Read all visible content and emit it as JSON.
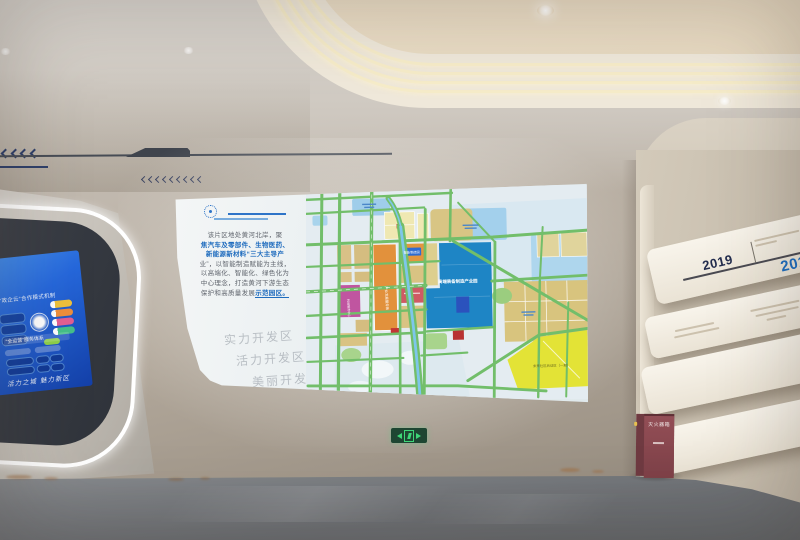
{
  "scene": {
    "description": "展厅实景：弧形灯带吊顶、墙面投影城市规划图、左侧蓝色触控屏、右侧年代墙、安全出口标识与灭火器箱"
  },
  "projection": {
    "intro": {
      "l1": "该片区地处黄河北岸，聚",
      "l2": "焦汽车及零部件、生物医药、",
      "l3": "新能源新材料“三大主导产",
      "l4": "业”，以智能制造赋能为主线，",
      "l5": "以高端化、智能化、绿色化为",
      "l6": "中心理念，打造黄河下游生态",
      "l7a": "保护和高质量发展",
      "l7b": "示范园区。"
    },
    "watermarks": {
      "w1": "实力开发区",
      "w2": "活力开发区",
      "w3": "美丽开发区"
    },
    "map": {
      "zone_blue": "高端装备制造产业园",
      "zone_corridor": "产业发展服务轴",
      "zone_magenta": "科创服务中心",
      "zone_yellow": "未来社区启动区（一期）",
      "tag_orange": "智能制造园"
    }
  },
  "kiosk": {
    "title1": "“政企云”合作模式机制",
    "title2": "“全运营”服务体系",
    "signature": "活力之城 魅力新区"
  },
  "timeline": {
    "year1": "2019",
    "year2": "2019"
  },
  "safety": {
    "fire_box_label": "灭火器箱"
  },
  "palette": {
    "led_warm": "#f6ecc9",
    "map_teal_zone": "#1e85c5",
    "map_orange_zone": "#e2913c",
    "map_magenta_zone": "#c055a0",
    "map_yellow_zone": "#e3e336",
    "kiosk_screen_blue": "#1a55cc",
    "exit_green": "#3fd678",
    "firebox_red": "#8a4b52",
    "timeline_navy": "#232d4e",
    "timeline_blue": "#1a6cc0"
  }
}
